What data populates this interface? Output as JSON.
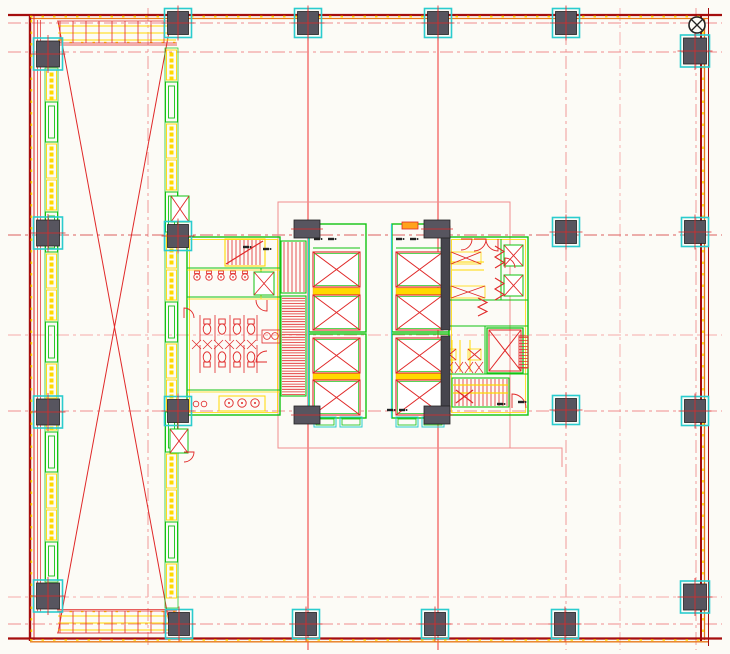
{
  "meta": {
    "drawing_type": "architectural-floor-plan",
    "content": "tower typical floor plate with core, atrium and structural grid",
    "visible_text": "none (fixture-scale glyphs illegible)"
  },
  "canvas": {
    "width": 730,
    "height": 654,
    "bg": "#fcfbf6"
  },
  "colors": {
    "red": "#e02828",
    "brightRed": "#ee1b1b",
    "darkRed": "#a50d0d",
    "orange": "#e87818",
    "pink": "#ef8e8e",
    "pinkDark": "#dd5f5f",
    "pinkLight": "#f6abab",
    "yellow": "#ffd900",
    "orangeYellow": "#ffa21e",
    "green": "#12c312",
    "teal": "#2accce",
    "dark": "#46454d",
    "colFill": "#57555f",
    "black": "#222222",
    "white": "#ffffff"
  },
  "grid": {
    "dash": "13 4 3 4",
    "verticals": [
      [
        148,
        8,
        648,
        "pink"
      ],
      [
        308,
        8,
        650,
        "brightRed",
        "solid"
      ],
      [
        438,
        8,
        650,
        "brightRed",
        "solid"
      ],
      [
        566,
        8,
        650,
        "pink"
      ],
      [
        620,
        8,
        650,
        "pinkLight"
      ],
      [
        696,
        8,
        650,
        "pink"
      ]
    ],
    "horizontals": [
      [
        23,
        8,
        722,
        "pink"
      ],
      [
        52,
        8,
        722,
        "pink"
      ],
      [
        235,
        8,
        722,
        "pinkDark"
      ],
      [
        335,
        8,
        722,
        "pinkLight"
      ],
      [
        411,
        8,
        722,
        "pink"
      ],
      [
        597,
        8,
        722,
        "pinkLight"
      ],
      [
        624,
        8,
        722,
        "pink"
      ]
    ]
  },
  "perimeter": {
    "lines": [
      [
        8,
        15,
        722,
        15,
        "darkRed",
        2.2
      ],
      [
        30,
        18.5,
        708,
        18.5,
        "orange",
        1.3
      ],
      [
        30,
        15,
        30,
        641,
        "darkRed",
        2.4
      ],
      [
        34,
        16,
        34,
        640,
        "red",
        1
      ],
      [
        37.5,
        20,
        37.5,
        612,
        "red",
        0.7
      ],
      [
        40.5,
        20,
        40.5,
        612,
        "red",
        0.7
      ],
      [
        701,
        16,
        701,
        641,
        "darkRed",
        2
      ],
      [
        704.5,
        18,
        704.5,
        640,
        "orange",
        1.3
      ],
      [
        708.5,
        8,
        708.5,
        646,
        "darkRed",
        1
      ],
      [
        8,
        638.5,
        722,
        638.5,
        "darkRed",
        2.2
      ],
      [
        30,
        641.8,
        708,
        641.8,
        "orange",
        1.3
      ],
      [
        57,
        45,
        177,
        45,
        "red",
        0.8
      ],
      [
        57,
        609.5,
        177,
        609.5,
        "red",
        0.8
      ]
    ],
    "yellowDashes": [
      [
        30,
        16.6,
        708,
        16.6
      ],
      [
        30,
        640,
        708,
        640
      ],
      [
        31.4,
        20,
        31.4,
        638
      ],
      [
        703,
        20,
        703,
        638
      ],
      [
        58,
        42.5,
        176,
        42.5
      ],
      [
        58,
        611.5,
        176,
        611.5
      ]
    ]
  },
  "atrium": {
    "cross": [
      [
        58,
        21,
        171,
        633
      ],
      [
        171,
        21,
        58,
        633
      ]
    ],
    "topBand": {
      "x0": 57,
      "x1": 177,
      "y0": 20,
      "y1": 44,
      "tickStep": 13,
      "yellowYs": [
        26,
        33,
        40
      ]
    },
    "bottomBand": {
      "x0": 57,
      "x1": 177,
      "y0": 610,
      "y1": 634,
      "tickStep": 13,
      "yellowYs": [
        616,
        623,
        630
      ]
    }
  },
  "strips": [
    {
      "x": 45,
      "w": 13,
      "y0": 68,
      "y1": 582,
      "cycle": [
        [
          "y",
          30
        ],
        [
          "g",
          40
        ],
        [
          "y",
          34
        ]
      ]
    },
    {
      "x": 165,
      "w": 13,
      "y0": 48,
      "y1": 608,
      "cycle": [
        [
          "y",
          30
        ],
        [
          "g",
          40
        ],
        [
          "y",
          34
        ]
      ]
    }
  ],
  "columns": {
    "size": [
      21,
      23
    ],
    "items": [
      [
        178,
        23
      ],
      [
        308,
        23
      ],
      [
        438,
        23
      ],
      [
        566,
        23
      ],
      [
        48,
        54,
        23,
        26
      ],
      [
        695,
        51,
        23,
        26
      ],
      [
        48,
        233,
        23,
        26
      ],
      [
        178,
        236
      ],
      [
        566,
        232
      ],
      [
        695,
        232
      ],
      [
        48,
        412,
        23,
        26
      ],
      [
        178,
        411
      ],
      [
        566,
        410
      ],
      [
        695,
        411
      ],
      [
        48,
        596,
        23,
        26
      ],
      [
        695,
        597,
        23,
        26
      ],
      [
        179,
        624
      ],
      [
        306,
        624
      ],
      [
        435,
        624
      ],
      [
        565,
        624
      ]
    ]
  },
  "core": {
    "pinkRect": [
      278,
      202,
      232,
      246
    ],
    "pinkL": [
      [
        510,
        448
      ],
      [
        562,
        448
      ],
      [
        562,
        467
      ]
    ],
    "banks": [
      {
        "x": 309
      },
      {
        "x": 392
      }
    ],
    "bank": {
      "outerTop": [
        0,
        224,
        57,
        108
      ],
      "outerBot": [
        0,
        334,
        57,
        84
      ],
      "shaftDx": 4,
      "shaftW": 47,
      "shaftYs": [
        252,
        295,
        338,
        380
      ],
      "shaftH": 35,
      "yellowBands": [
        288,
        373
      ],
      "machineY": 248
    },
    "stubs": [
      [
        294,
        220,
        26,
        18
      ],
      [
        294,
        406,
        26,
        18
      ],
      [
        424,
        220,
        26,
        18
      ],
      [
        424,
        406,
        26,
        18
      ]
    ],
    "darkWalls": [
      [
        441,
        226,
        9,
        104
      ],
      [
        441,
        336,
        9,
        78
      ]
    ],
    "toilet": {
      "rect": [
        187,
        237,
        93,
        178
      ],
      "innerLines": [
        [
          187,
          268,
          280,
          268
        ],
        [
          187,
          297,
          280,
          297
        ],
        [
          187,
          390,
          280,
          390
        ],
        [
          261,
          268,
          261,
          297
        ]
      ],
      "urinals": {
        "y": 277,
        "xs": [
          197,
          209,
          221,
          233,
          245
        ]
      },
      "wcRows": [
        {
          "y": 329,
          "seat": "up",
          "xs": [
            207,
            222,
            237,
            251
          ]
        },
        {
          "y": 357,
          "seat": "down",
          "xs": [
            207,
            222,
            237,
            251
          ]
        }
      ],
      "partitions": {
        "xs": [
          200,
          215,
          230,
          244,
          257
        ],
        "rows": [
          [
            315,
            341
          ],
          [
            345,
            373
          ]
        ]
      },
      "xband": [
        192,
        340,
        66,
        9
      ],
      "basins": {
        "rect": [
          262,
          330,
          18,
          13
        ],
        "pts": [
          [
            267,
            336
          ],
          [
            275,
            336
          ]
        ]
      },
      "sinks": {
        "rect": [
          219,
          396,
          46,
          15
        ],
        "pts": [
          [
            229,
            403
          ],
          [
            242,
            403
          ],
          [
            255,
            403
          ]
        ],
        "small": [
          [
            196,
            404
          ],
          [
            204,
            404
          ]
        ]
      }
    },
    "service": {
      "rect": [
        449,
        237,
        79,
        178
      ],
      "innerLines": [
        [
          501,
          239,
          501,
          300
        ],
        [
          449,
          300,
          528,
          300
        ],
        [
          449,
          326,
          528,
          326
        ],
        [
          485,
          326,
          485,
          374
        ],
        [
          449,
          374,
          528,
          374
        ]
      ],
      "bowties": [
        [
          451,
          252,
          30,
          12
        ],
        [
          451,
          286,
          34,
          12
        ],
        [
          443,
          349,
          13,
          11
        ],
        [
          468,
          349,
          13,
          11
        ]
      ],
      "xband": [
        445,
        362,
        40,
        11
      ],
      "yellowLines": [
        [
          452,
          262,
          484,
          262
        ],
        [
          452,
          270,
          484,
          270
        ],
        [
          452,
          340,
          452,
          372
        ],
        [
          460,
          340,
          460,
          372
        ],
        [
          470,
          340,
          470,
          372
        ]
      ],
      "lift": [
        487,
        328,
        36,
        45
      ],
      "ladder": [
        519,
        336,
        9,
        32
      ]
    },
    "stairs": [
      {
        "rect": [
          225,
          239,
          40,
          27
        ],
        "dir": "v",
        "gap": 4,
        "frame": "yellow",
        "diag": [
          226,
          264,
          263,
          241
        ]
      },
      {
        "rect": [
          281,
          241,
          25,
          52
        ],
        "dir": "v",
        "gap": 4,
        "frame": "green"
      },
      {
        "rect": [
          281,
          296,
          25,
          100
        ],
        "dir": "h",
        "gap": 2.6,
        "frame": "green"
      },
      {
        "rect": [
          452,
          378,
          57,
          29
        ],
        "dir": "v",
        "gap": 4,
        "frame": "green",
        "cross": [
          456,
          390,
          473,
          403
        ],
        "yl": [
          385,
          393
        ]
      }
    ],
    "xboxes": [
      [
        171,
        196,
        18,
        26
      ],
      [
        170,
        429,
        18,
        24
      ],
      [
        254,
        272,
        20,
        23
      ],
      [
        504,
        245,
        19,
        21
      ],
      [
        504,
        275,
        19,
        21
      ]
    ],
    "doors": [
      [
        474,
        239,
        12,
        0
      ],
      [
        498,
        239,
        12,
        90
      ],
      [
        461,
        239,
        11,
        0
      ],
      [
        267,
        300,
        11,
        90
      ],
      [
        267,
        362,
        11,
        180
      ],
      [
        505,
        268,
        10,
        270
      ],
      [
        512,
        408,
        14,
        270
      ],
      [
        184,
        318,
        10,
        270
      ],
      [
        184,
        452,
        10,
        0
      ]
    ],
    "zigzags": [
      [
        495,
        246,
        22
      ],
      [
        495,
        278,
        22
      ],
      [
        478,
        298,
        18
      ]
    ],
    "marks": [
      [
        317,
        239
      ],
      [
        331,
        239
      ],
      [
        399,
        239
      ],
      [
        413,
        239
      ],
      [
        246,
        247
      ],
      [
        266,
        249
      ],
      [
        390,
        410
      ],
      [
        402,
        410
      ],
      [
        500,
        404
      ],
      [
        521,
        402
      ]
    ],
    "lobbyPads": [
      [
        314,
        417,
        22,
        10
      ],
      [
        340,
        417,
        22,
        10
      ],
      [
        396,
        417,
        22,
        10
      ],
      [
        422,
        417,
        22,
        10
      ]
    ],
    "miniRect": [
      402,
      222,
      16,
      7
    ]
  },
  "marker": {
    "x": 697,
    "y": 25,
    "r": 8
  }
}
